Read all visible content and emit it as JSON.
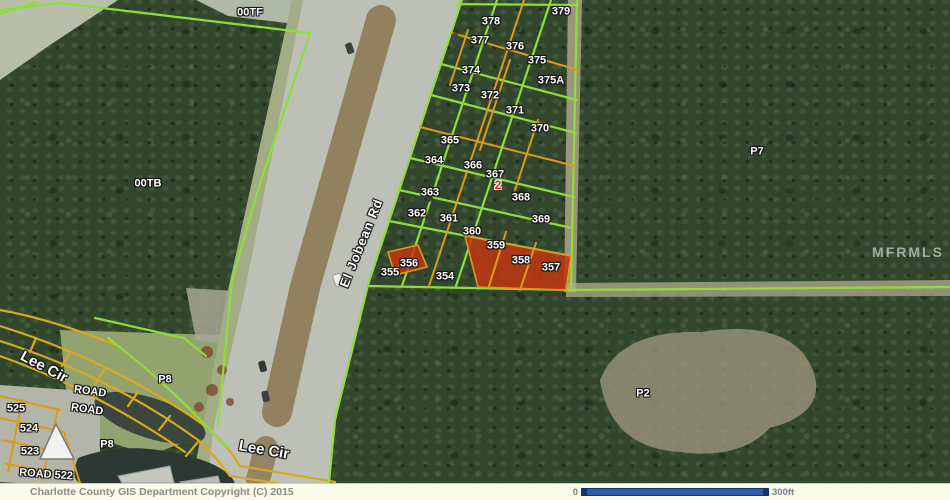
{
  "map": {
    "labels": [
      {
        "t": "379",
        "x": 561,
        "y": 12,
        "k": "parcel"
      },
      {
        "t": "378",
        "x": 491,
        "y": 22,
        "k": "parcel"
      },
      {
        "t": "377",
        "x": 480,
        "y": 41,
        "k": "parcel"
      },
      {
        "t": "376",
        "x": 515,
        "y": 47,
        "k": "parcel"
      },
      {
        "t": "375",
        "x": 537,
        "y": 61,
        "k": "parcel"
      },
      {
        "t": "374",
        "x": 471,
        "y": 71,
        "k": "parcel"
      },
      {
        "t": "375A",
        "x": 551,
        "y": 81,
        "k": "parcel"
      },
      {
        "t": "373",
        "x": 461,
        "y": 89,
        "k": "parcel"
      },
      {
        "t": "372",
        "x": 490,
        "y": 96,
        "k": "parcel"
      },
      {
        "t": "371",
        "x": 515,
        "y": 111,
        "k": "parcel"
      },
      {
        "t": "370",
        "x": 540,
        "y": 129,
        "k": "parcel"
      },
      {
        "t": "365",
        "x": 450,
        "y": 141,
        "k": "parcel"
      },
      {
        "t": "364",
        "x": 434,
        "y": 161,
        "k": "parcel"
      },
      {
        "t": "366",
        "x": 473,
        "y": 166,
        "k": "parcel"
      },
      {
        "t": "367",
        "x": 495,
        "y": 175,
        "k": "parcel"
      },
      {
        "t": "2",
        "x": 498,
        "y": 185,
        "k": "marker"
      },
      {
        "t": "368",
        "x": 521,
        "y": 198,
        "k": "parcel"
      },
      {
        "t": "363",
        "x": 430,
        "y": 193,
        "k": "parcel"
      },
      {
        "t": "362",
        "x": 417,
        "y": 214,
        "k": "parcel"
      },
      {
        "t": "361",
        "x": 449,
        "y": 219,
        "k": "parcel"
      },
      {
        "t": "369",
        "x": 541,
        "y": 220,
        "k": "parcel"
      },
      {
        "t": "360",
        "x": 472,
        "y": 232,
        "k": "parcel"
      },
      {
        "t": "359",
        "x": 496,
        "y": 246,
        "k": "parcel"
      },
      {
        "t": "358",
        "x": 521,
        "y": 261,
        "k": "parcel"
      },
      {
        "t": "357",
        "x": 551,
        "y": 268,
        "k": "parcel"
      },
      {
        "t": "356",
        "x": 409,
        "y": 264,
        "k": "parcel"
      },
      {
        "t": "355",
        "x": 390,
        "y": 273,
        "k": "parcel"
      },
      {
        "t": "354",
        "x": 445,
        "y": 277,
        "k": "parcel"
      },
      {
        "t": "00TF",
        "x": 250,
        "y": 13,
        "k": "parcel"
      },
      {
        "t": "00TB",
        "x": 148,
        "y": 184,
        "k": "parcel"
      },
      {
        "t": "P7",
        "x": 757,
        "y": 152,
        "k": "parcel"
      },
      {
        "t": "P2",
        "x": 643,
        "y": 394,
        "k": "parcel"
      },
      {
        "t": "P8",
        "x": 165,
        "y": 380,
        "k": "parcel"
      },
      {
        "t": "P8",
        "x": 107,
        "y": 445,
        "k": "parcel"
      },
      {
        "t": "525",
        "x": 16,
        "y": 409,
        "k": "parcel"
      },
      {
        "t": "524",
        "x": 29,
        "y": 429,
        "k": "parcel"
      },
      {
        "t": "523",
        "x": 30,
        "y": 452,
        "k": "parcel"
      },
      {
        "t": "ROAD",
        "x": 90,
        "y": 392,
        "r": 8,
        "k": "parcel"
      },
      {
        "t": "ROAD",
        "x": 87,
        "y": 410,
        "r": 8,
        "k": "parcel"
      },
      {
        "t": "ROAD 522",
        "x": 46,
        "y": 475,
        "r": 4,
        "k": "parcel"
      },
      {
        "t": "Lee Cir",
        "x": 44,
        "y": 367,
        "r": 28,
        "k": "road"
      },
      {
        "t": "Lee Cir",
        "x": 264,
        "y": 450,
        "r": 10,
        "k": "road"
      },
      {
        "t": "El Jobean Rd",
        "x": 361,
        "y": 243,
        "r": -68,
        "k": "street"
      },
      {
        "t": "MFRMLS",
        "x": 908,
        "y": 252,
        "k": "watermark"
      }
    ]
  },
  "footer": {
    "copyright": "Charlotte County GIS Department Copyright (C) 2015",
    "scale": {
      "start": "0",
      "end": "300ft"
    }
  },
  "colors": {
    "green_line": "#8fdd3a",
    "orange_line": "#dc9a18",
    "yellow_road": "#d9a81f",
    "red_fill": "#c23510",
    "red_marker": "#e02818",
    "pavement": "#bcc0b7",
    "median": "#8f7d5a",
    "shoulder": "#a3ad85",
    "forest": "#31462d",
    "sand": "#9b947c",
    "water": "#2c3834",
    "field": "#92a370",
    "clearing": "#b7bfab",
    "concrete": "#b3b5a8",
    "footer_bg": "#fbfbe9",
    "footer_text": "#8b8b82",
    "scale_blue": "#2d5ca6",
    "scale_border": "#12336e",
    "scale_text": "#75808c"
  }
}
